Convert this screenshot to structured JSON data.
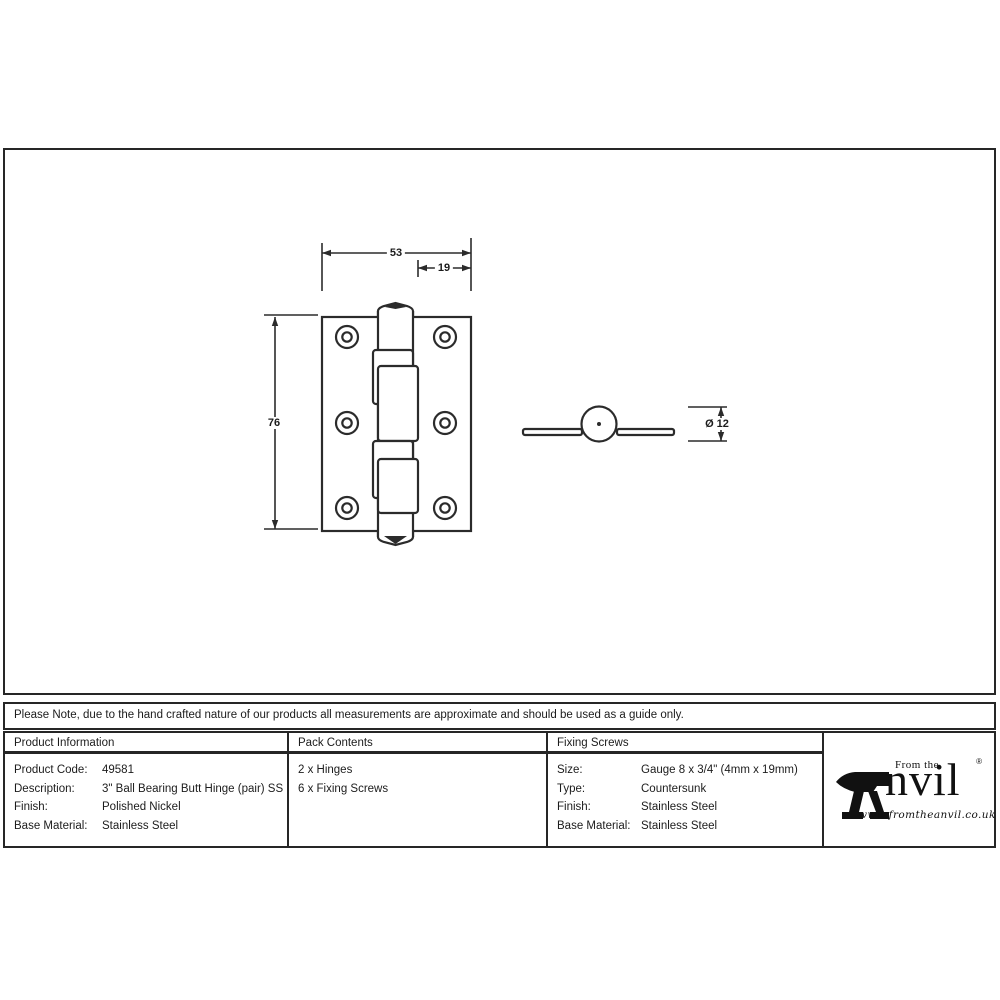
{
  "drawing": {
    "front_view": {
      "dim_width": "53",
      "dim_leaf": "19",
      "dim_height": "76"
    },
    "side_view": {
      "dim_diameter": "Ø 12"
    }
  },
  "note": {
    "text": "Please Note, due to the hand crafted nature of our products all measurements are approximate and should be used as a guide only."
  },
  "table": {
    "product_information": {
      "header": "Product Information",
      "rows": [
        {
          "label": "Product Code:",
          "value": "49581"
        },
        {
          "label": "Description:",
          "value": "3\" Ball Bearing Butt Hinge (pair) SS"
        },
        {
          "label": "Finish:",
          "value": "Polished Nickel"
        },
        {
          "label": "Base Material:",
          "value": "Stainless Steel"
        }
      ]
    },
    "pack_contents": {
      "header": "Pack Contents",
      "items": [
        "2 x Hinges",
        "6 x Fixing Screws"
      ]
    },
    "fixing_screws": {
      "header": "Fixing Screws",
      "rows": [
        {
          "label": "Size:",
          "value": "Gauge 8 x 3/4\" (4mm x 19mm)"
        },
        {
          "label": "Type:",
          "value": "Countersunk"
        },
        {
          "label": "Finish:",
          "value": "Stainless Steel"
        },
        {
          "label": "Base Material:",
          "value": "Stainless Steel"
        }
      ]
    }
  },
  "brand": {
    "tagline": "From the",
    "name_rest": "nvil",
    "registered": "®",
    "website": "www.fromtheanvil.co.uk"
  },
  "colors": {
    "line": "#2b2b2b",
    "border": "#262626",
    "text": "#1c1c1c"
  }
}
